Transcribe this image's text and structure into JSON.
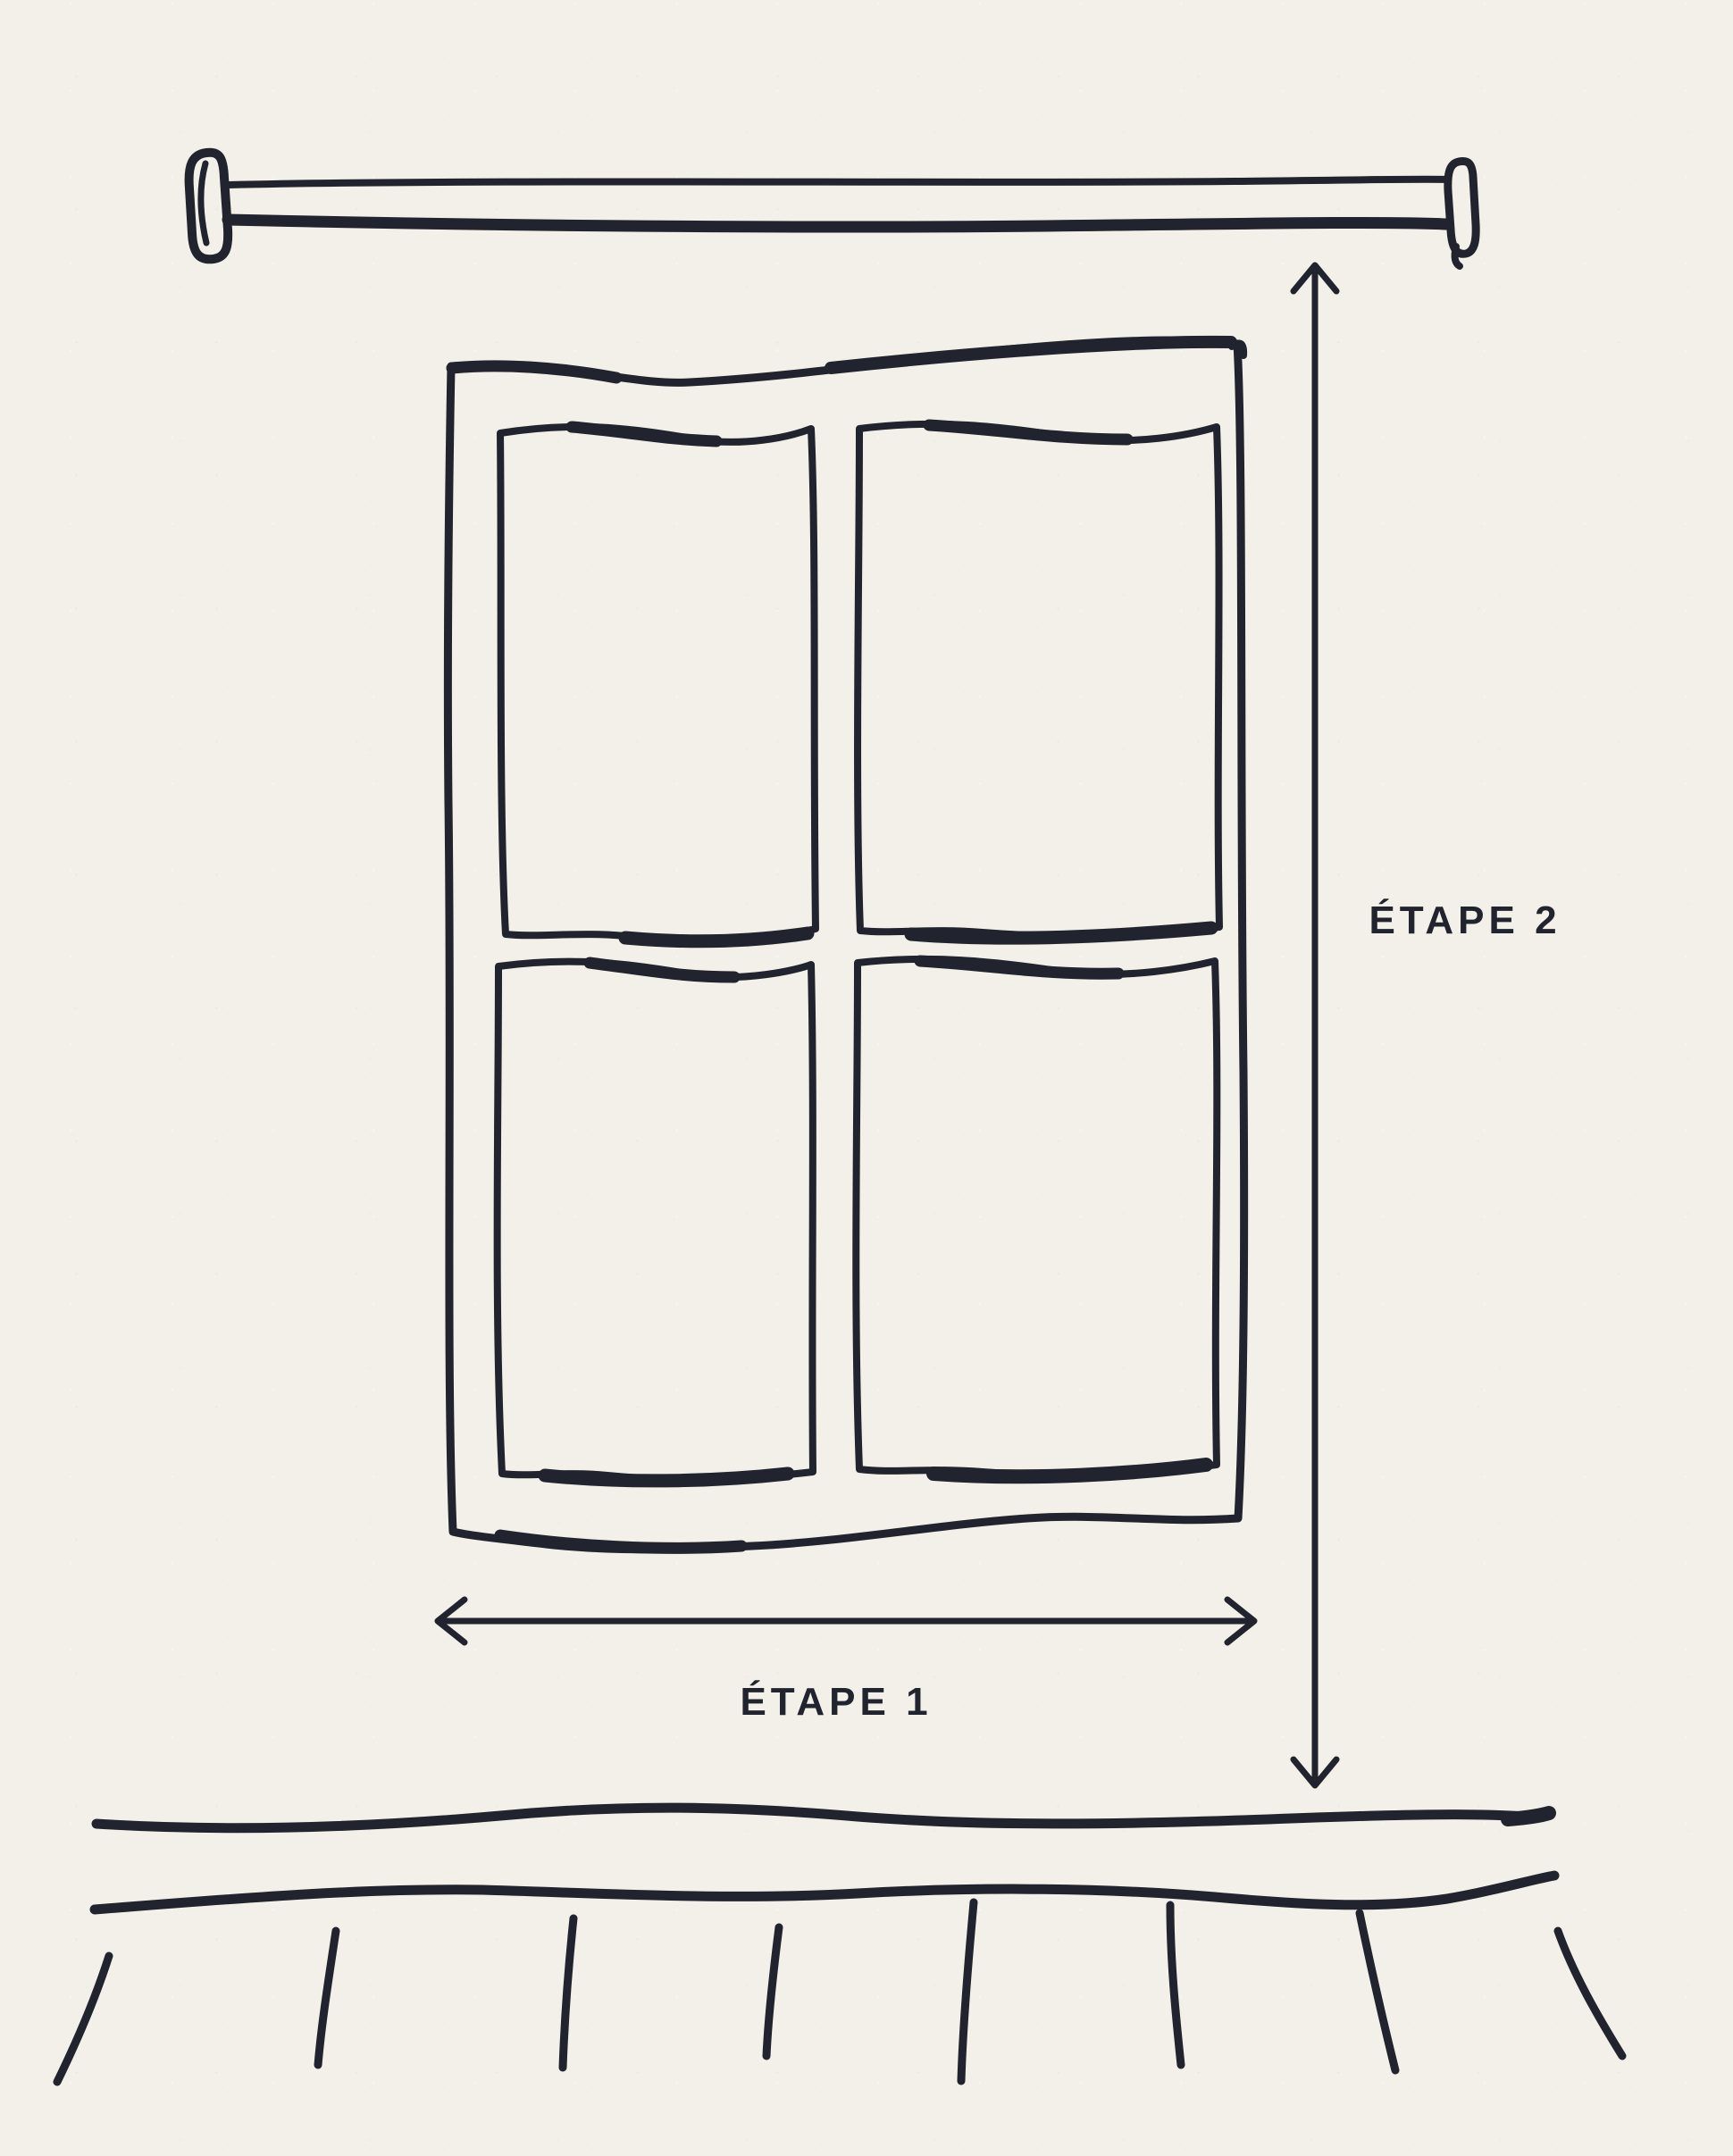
{
  "labels": {
    "step1": "ÉTAPE 1",
    "step2": "ÉTAPE 2"
  },
  "colors": {
    "ink": "#21242e",
    "paper": "#f2f0e9"
  }
}
